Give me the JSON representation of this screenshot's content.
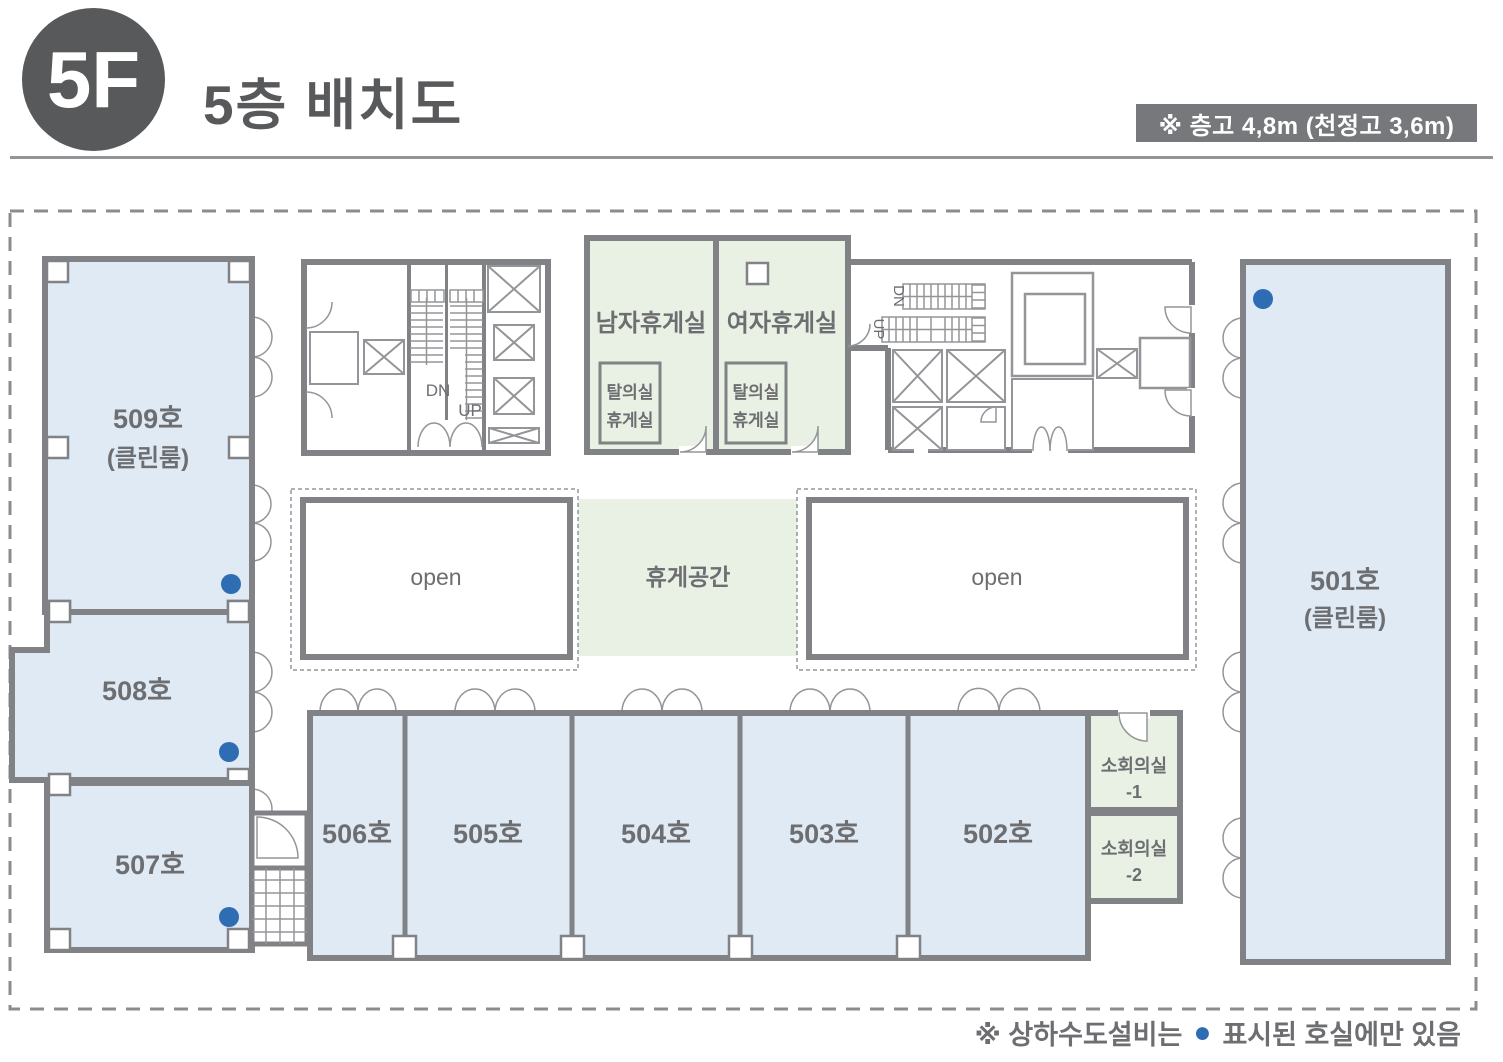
{
  "header": {
    "floor_badge": "5F",
    "title": "5층 배치도",
    "height_note": "※ 층고 4,8m (천정고 3,6m)"
  },
  "colors": {
    "room_blue": "#dfeaf4",
    "room_green": "#e9f0e4",
    "wall_gray": "#808285",
    "accent_blue": "#2e6db4",
    "label_gray": "#6d6e71"
  },
  "rooms": {
    "r509": {
      "name": "509호",
      "sub": "(클린룸)"
    },
    "r508": {
      "name": "508호"
    },
    "r507": {
      "name": "507호"
    },
    "r506": {
      "name": "506호"
    },
    "r505": {
      "name": "505호"
    },
    "r504": {
      "name": "504호"
    },
    "r503": {
      "name": "503호"
    },
    "r502": {
      "name": "502호"
    },
    "r501": {
      "name": "501호",
      "sub": "(클린룸)"
    },
    "men_lounge": {
      "name": "남자휴게실",
      "inner_line1": "탈의실",
      "inner_line2": "휴게실"
    },
    "women_lounge": {
      "name": "여자휴게실",
      "inner_line1": "탈의실",
      "inner_line2": "휴게실"
    },
    "meeting1": {
      "line1": "소회의실",
      "line2": "-1"
    },
    "meeting2": {
      "line1": "소회의실",
      "line2": "-2"
    },
    "open_left": {
      "name": "open"
    },
    "open_right": {
      "name": "open"
    },
    "rest_area": {
      "name": "휴게공간"
    }
  },
  "stairs": {
    "left": {
      "dn": "DN",
      "up": "UP"
    },
    "right": {
      "dn": "DN",
      "up": "UP"
    }
  },
  "footer": {
    "note_prefix": "※ 상하수도설비는",
    "marker": "●",
    "note_suffix": "표시된 호실에만 있음"
  }
}
